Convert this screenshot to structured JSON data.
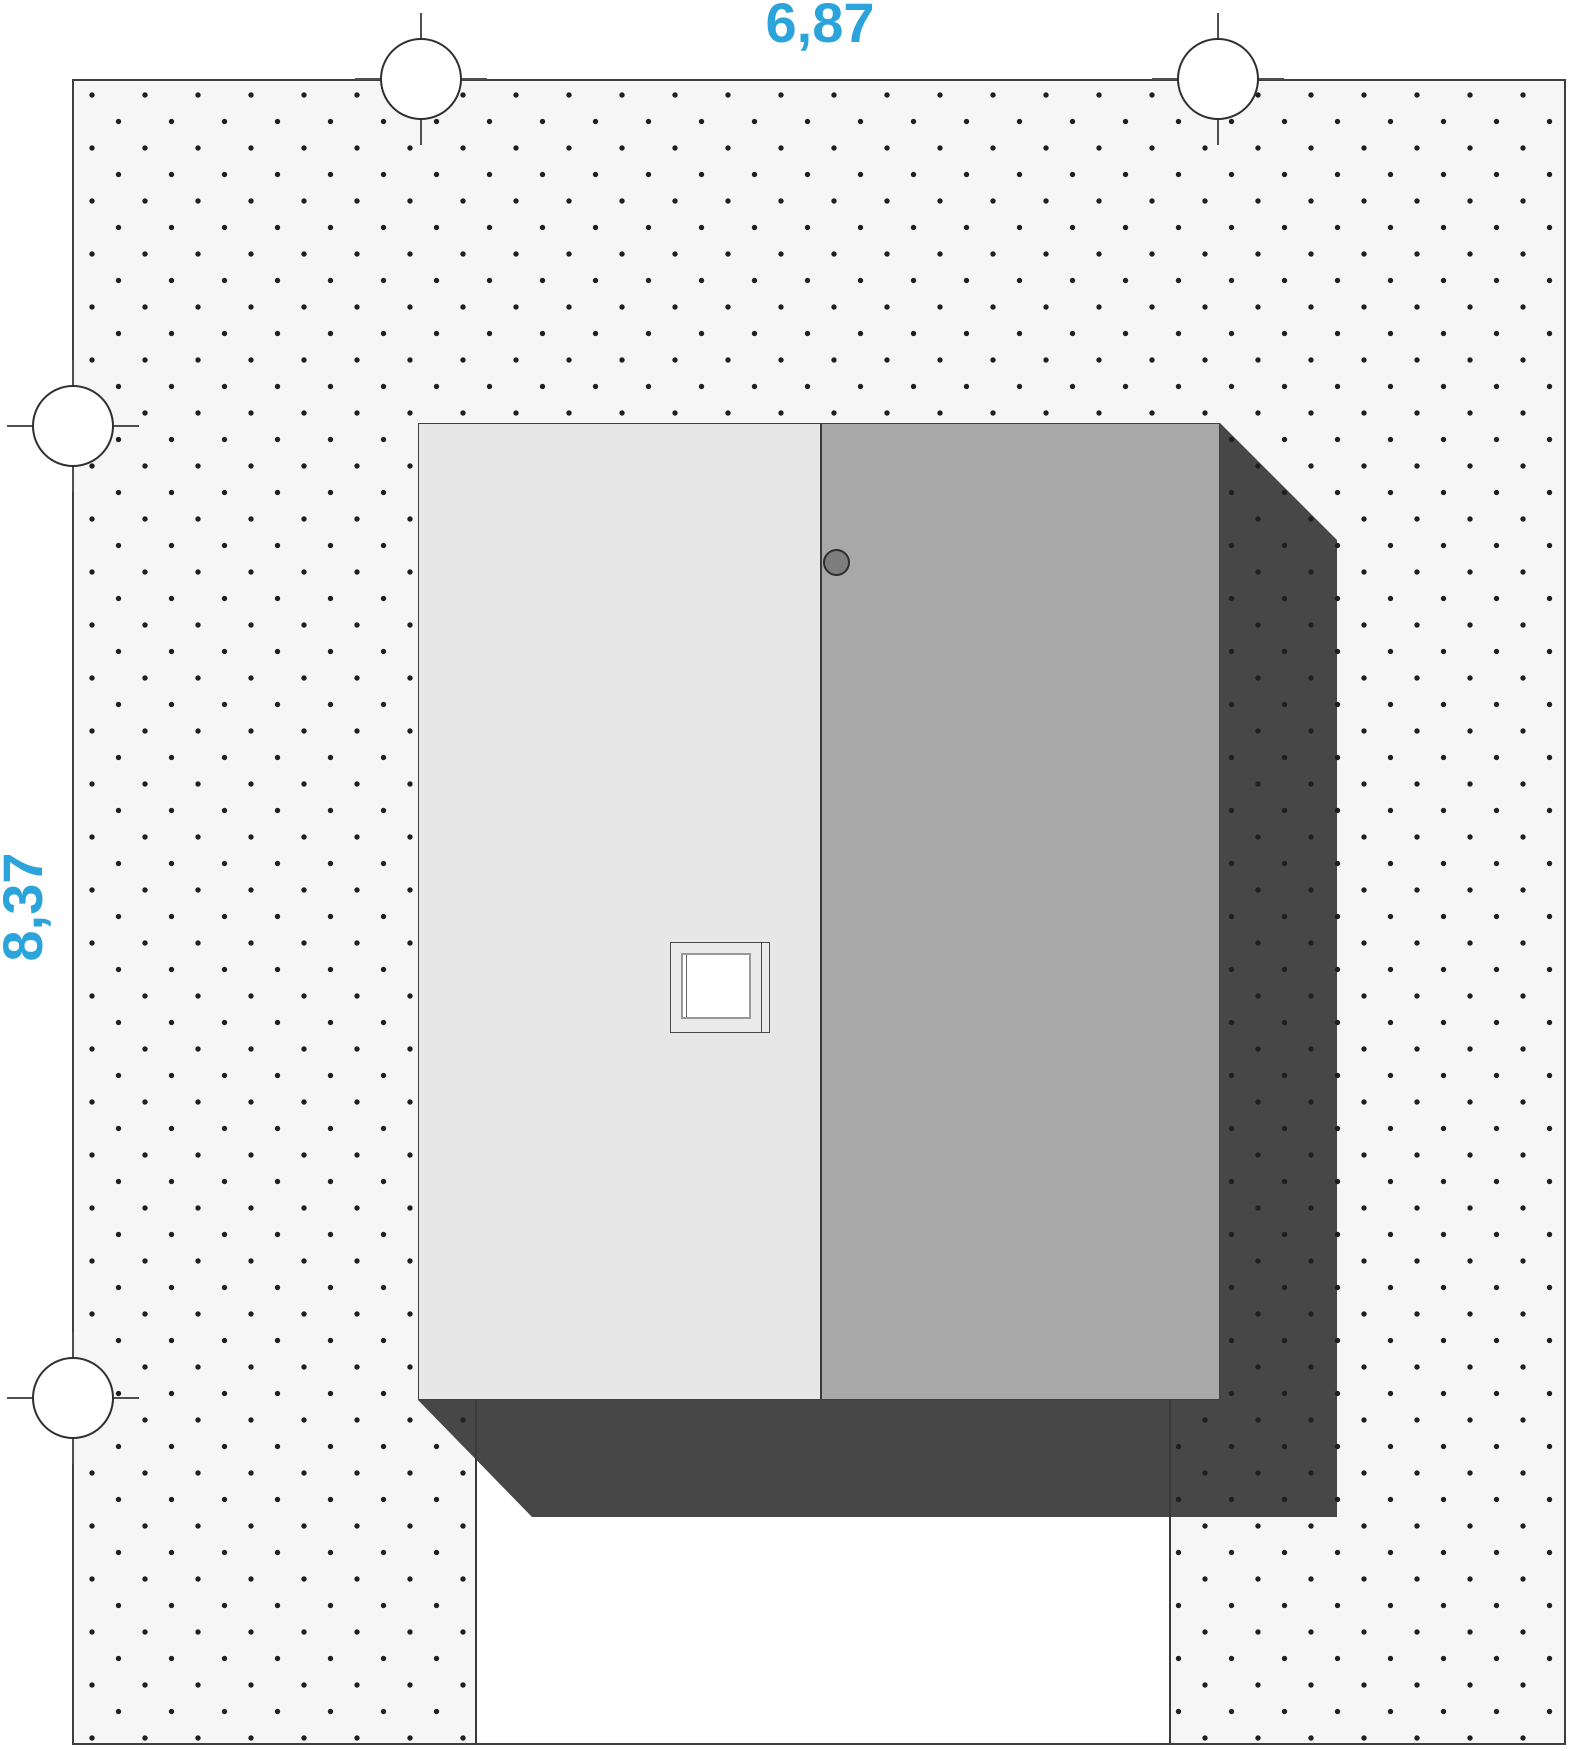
{
  "drawing": {
    "kind": "roof-site-plan"
  },
  "dimensions": {
    "width_label": "6,87",
    "height_label": "8,37"
  },
  "colors": {
    "accent": "#2ba3db",
    "plot_bg": "#f6f6f6",
    "dot": "#1f1f1f",
    "outline": "#3f3f3f",
    "roof_light": "#e7e7e7",
    "roof_dark": "#a8a8a8",
    "shadow": "#474747",
    "vent": "#7d7d7d",
    "skylight_frame": "#eaeaea",
    "tree_fill": "#ffffff"
  }
}
